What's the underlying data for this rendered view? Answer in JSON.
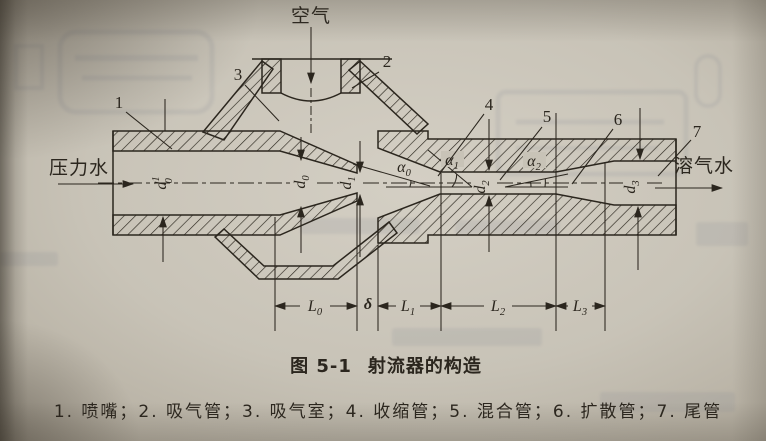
{
  "page": {
    "caption": {
      "number": "图 5-1",
      "title": "射流器的构造"
    },
    "legend_text": "1. 喷嘴；2. 吸气管；3. 吸气室；4. 收缩管；5. 混合管；6. 扩散管；7. 尾管"
  },
  "flows": {
    "air": "空气",
    "pressure_water": "压力水",
    "dissolved_gas_water": "溶气水"
  },
  "parts": [
    {
      "num": "1",
      "name": "喷嘴"
    },
    {
      "num": "2",
      "name": "吸气管"
    },
    {
      "num": "3",
      "name": "吸气室"
    },
    {
      "num": "4",
      "name": "收缩管"
    },
    {
      "num": "5",
      "name": "混合管"
    },
    {
      "num": "6",
      "name": "扩散管"
    },
    {
      "num": "7",
      "name": "尾管"
    }
  ],
  "dims": {
    "d01": {
      "base": "d",
      "sub": "0",
      "sup": "1"
    },
    "d0": {
      "base": "d",
      "sub": "0"
    },
    "d1": {
      "base": "d",
      "sub": "1"
    },
    "d2": {
      "base": "d",
      "sub": "2"
    },
    "d3": {
      "base": "d",
      "sub": "3"
    },
    "L0": {
      "base": "L",
      "sub": "0"
    },
    "L1": {
      "base": "L",
      "sub": "1"
    },
    "L2": {
      "base": "L",
      "sub": "2"
    },
    "L3": {
      "base": "L",
      "sub": "3"
    },
    "delta": "δ",
    "alpha0": {
      "base": "α",
      "sub": "0"
    },
    "alpha1": {
      "base": "α",
      "sub": "1"
    },
    "alpha2": {
      "base": "α",
      "sub": "2"
    }
  },
  "colors": {
    "ink": "#2b261e",
    "paper": "#c9c4b9"
  }
}
